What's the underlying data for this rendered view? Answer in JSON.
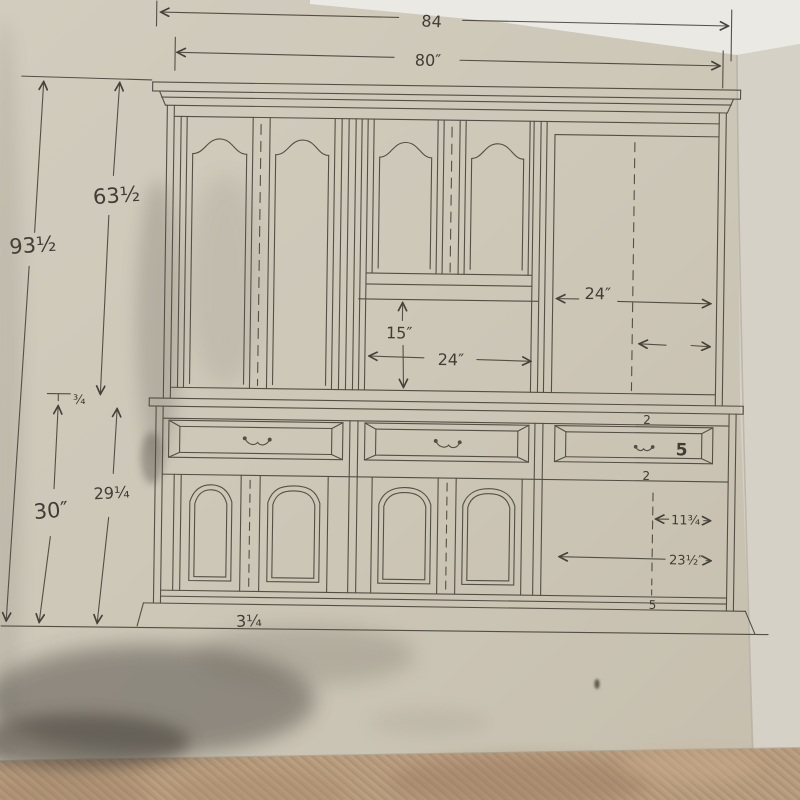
{
  "dimensions": {
    "top_outer_width": "84",
    "top_inner_width": "80″",
    "overall_height": "93½",
    "upper_section_height": "63½",
    "waist_thickness": "¾",
    "lower_section_height": "30″",
    "lower_inner_height": "29¼",
    "center_opening_height": "15″",
    "center_opening_width": "24″",
    "right_bay_width": "24″",
    "right_rail_top": "2",
    "right_drawer_depth": "5",
    "right_rail_bottom": "2",
    "right_half_width": "11¾",
    "right_opening_width": "23½″",
    "right_bottom_rail": "5",
    "base_height": "3¼"
  }
}
